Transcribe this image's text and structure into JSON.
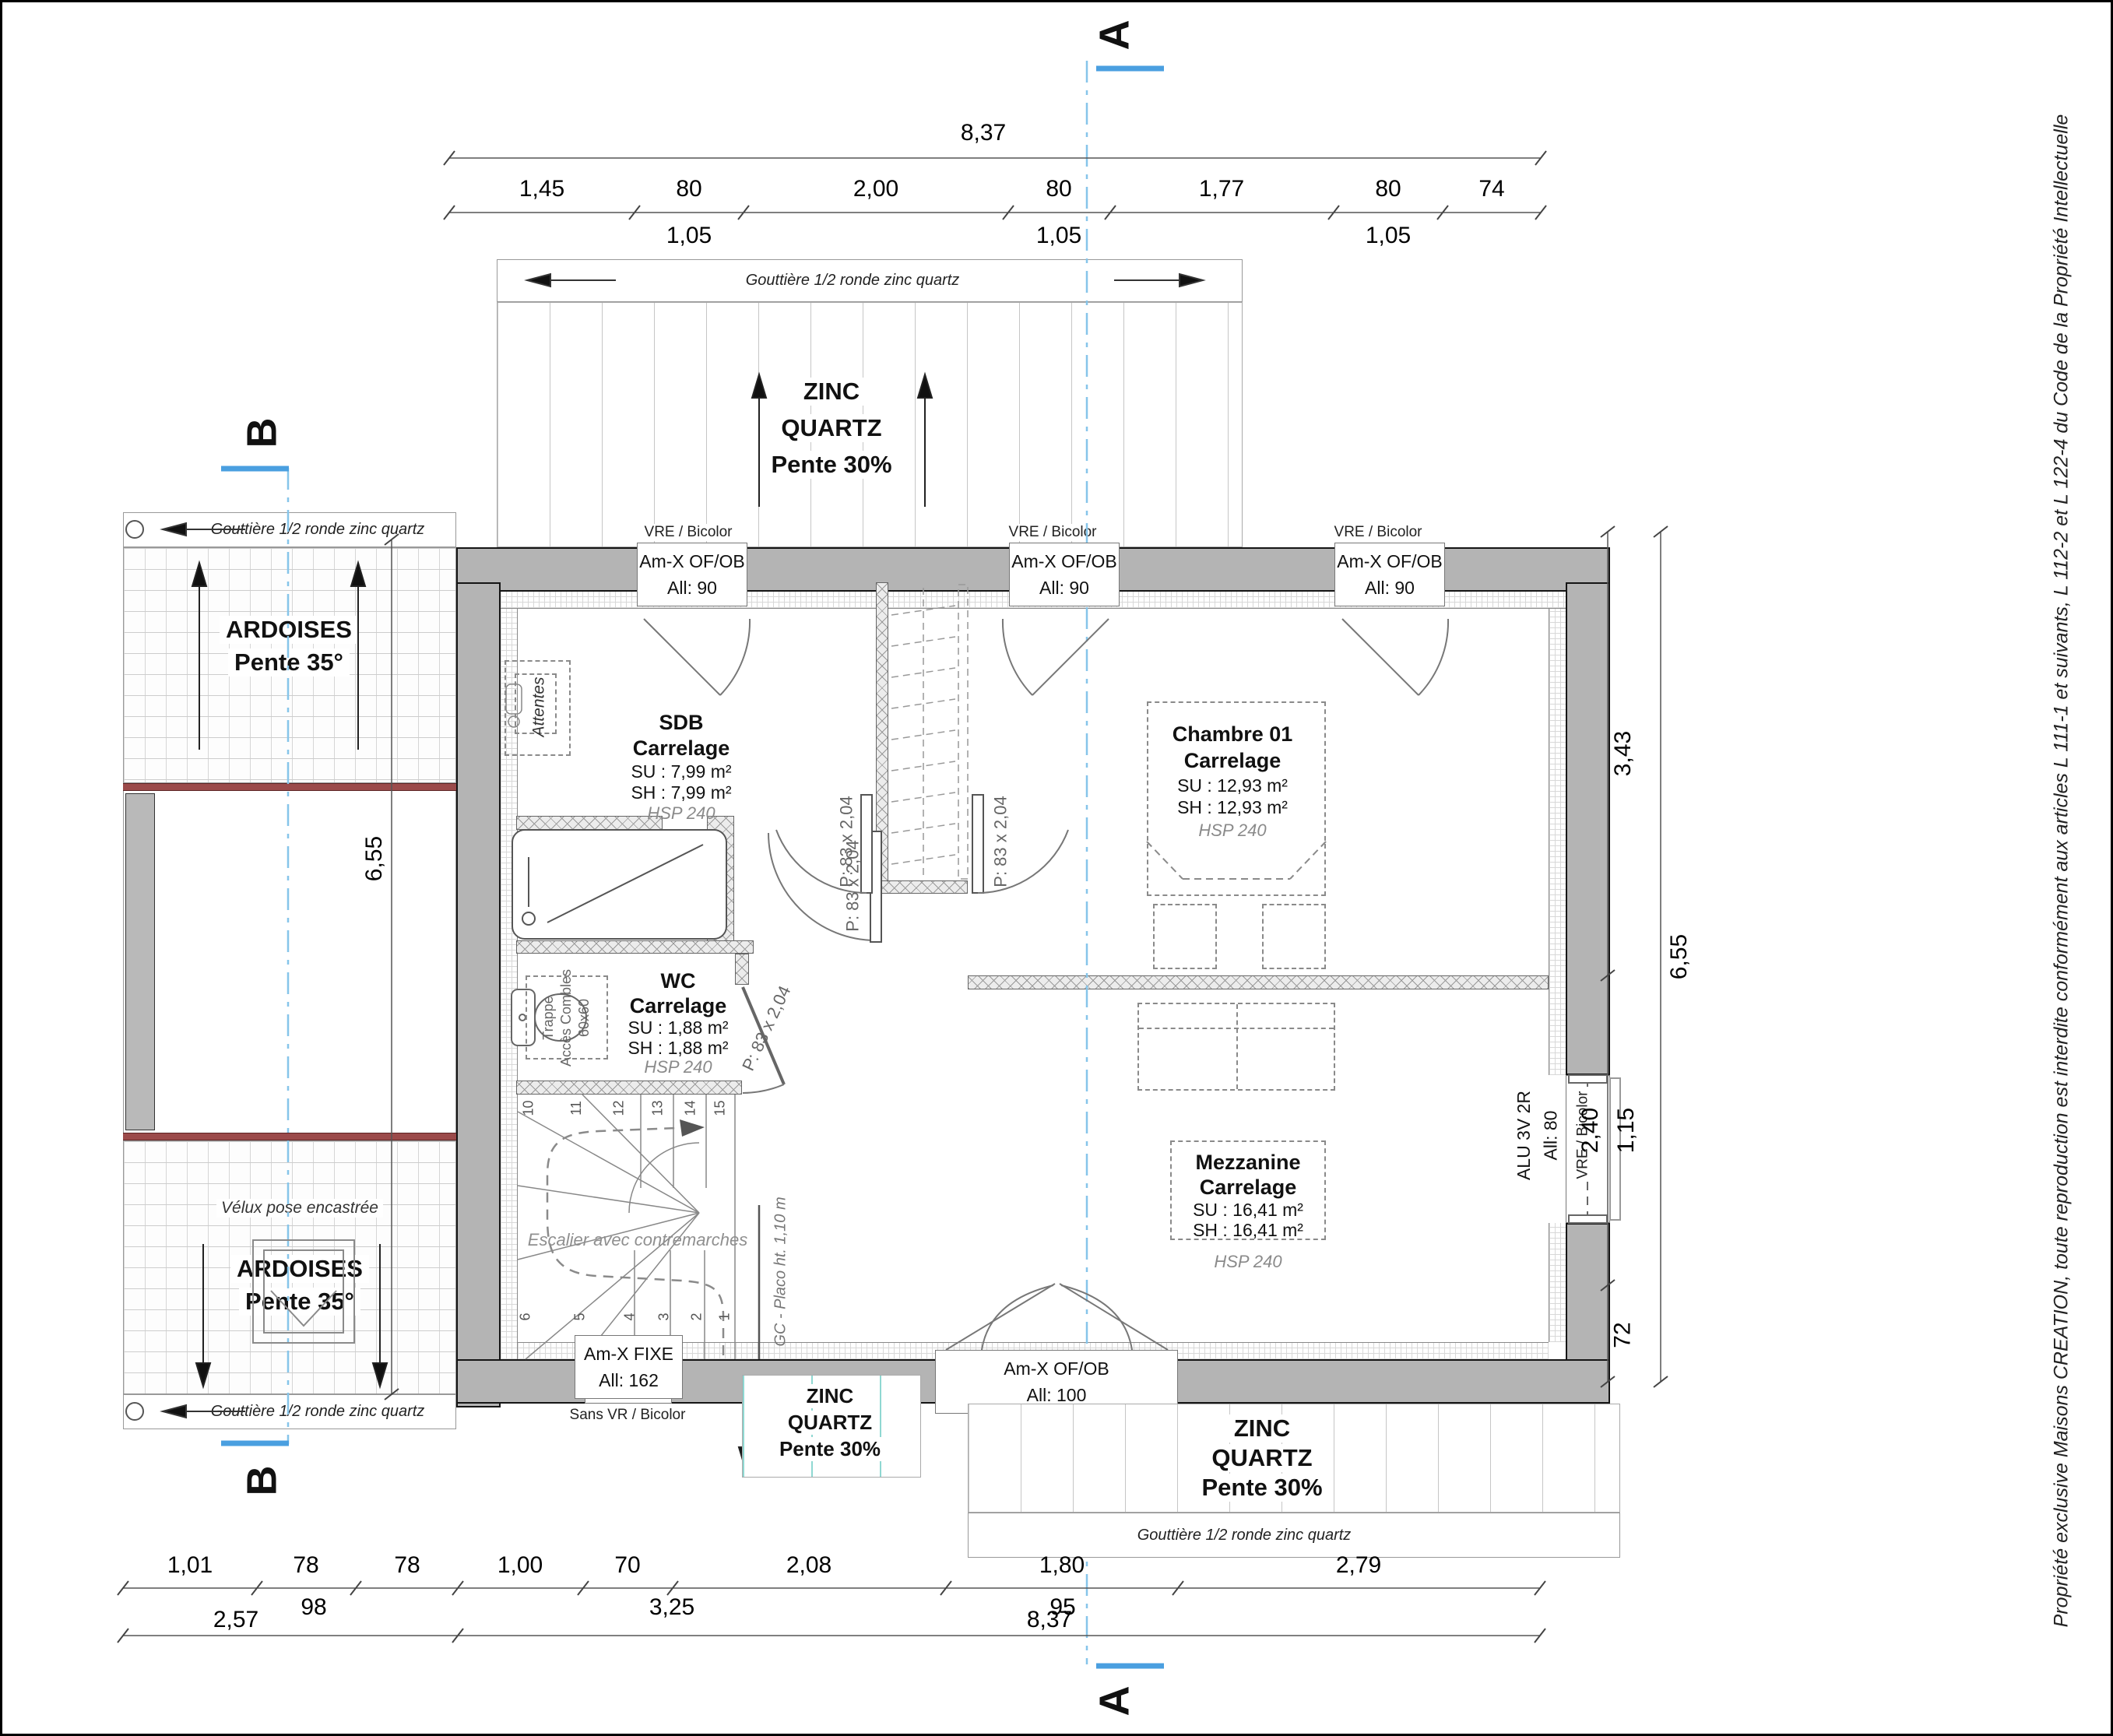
{
  "sheet": {
    "copyright": "Propriété exclusive Maisons CREATION, toute reproduction est interdite conformément aux articles L 111-1 et suivants, L 112-2 et L 122-4 du Code de la Propriété Intellectuelle"
  },
  "sections": {
    "a": "A",
    "b": "B"
  },
  "dims": {
    "top_overall": "8,37",
    "top_row": [
      "1,45",
      "80",
      "2,00",
      "80",
      "1,77",
      "80",
      "74"
    ],
    "top_sub": [
      "1,05",
      "1,05",
      "1,05"
    ],
    "bottom_row": [
      "1,01",
      "78",
      "78",
      "1,00",
      "70",
      "2,08",
      "1,80",
      "2,79"
    ],
    "bottom_sub": [
      "98",
      "3,25",
      "95"
    ],
    "bottom_row2": [
      "2,57",
      "8,37"
    ],
    "left_overall": "6,55",
    "right_overall": "6,55",
    "right_segments": [
      "3,43",
      "2,40",
      "1,15",
      "72"
    ]
  },
  "roof": {
    "gutter": "Gouttière 1/2 ronde zinc quartz",
    "zinc": [
      "ZINC",
      "QUARTZ",
      "Pente 30%"
    ],
    "ardoises": [
      "ARDOISES",
      "Pente 35°"
    ],
    "velux": "Vélux pose encastrée"
  },
  "windows": {
    "vre": "VRE / Bicolor",
    "top": {
      "name": "Am-X OF/OB",
      "all": "All: 90"
    },
    "fixe": {
      "name": "Am-X FIXE",
      "all": "All: 162",
      "note": "Sans VR / Bicolor"
    },
    "south": {
      "name": "Am-X OF/OB",
      "all": "All: 100"
    },
    "alu": {
      "name": "ALU 3V 2R",
      "all": "All: 80"
    }
  },
  "doors": {
    "label": "P: 83 x 2,04"
  },
  "rooms": {
    "sdb": {
      "name": "SDB",
      "finish": "Carrelage",
      "su": "SU : 7,99 m²",
      "sh": "SH : 7,99 m²",
      "hsp": "HSP 240"
    },
    "wc": {
      "name": "WC",
      "finish": "Carrelage",
      "su": "SU : 1,88 m²",
      "sh": "SH : 1,88 m²",
      "hsp": "HSP 240"
    },
    "chambre": {
      "name": "Chambre 01",
      "finish": "Carrelage",
      "su": "SU : 12,93 m²",
      "sh": "SH : 12,93 m²",
      "hsp": "HSP 240"
    },
    "mezzanine": {
      "name": "Mezzanine",
      "finish": "Carrelage",
      "su": "SU : 16,41 m²",
      "sh": "SH : 16,41 m²",
      "hsp": "HSP 240"
    }
  },
  "stairs": {
    "note": "Escalier avec contremarches",
    "gc": "GC - Placo ht. 1,10 m",
    "numbers": [
      "1",
      "2",
      "3",
      "4",
      "5",
      "6",
      "10",
      "11",
      "12",
      "13",
      "14",
      "15"
    ]
  },
  "annotations": {
    "attentes": "Attentes",
    "trappe_l1": "Trappe",
    "trappe_l2": "Accès Combles",
    "trappe_l3": "60x60"
  },
  "colors": {
    "section_line": "#86c5ea",
    "marker_blue": "#4a9fe0",
    "wall": "#b4b4b4",
    "red_band": "#9b4a4a",
    "teal_seam": "#8fd8d2"
  }
}
